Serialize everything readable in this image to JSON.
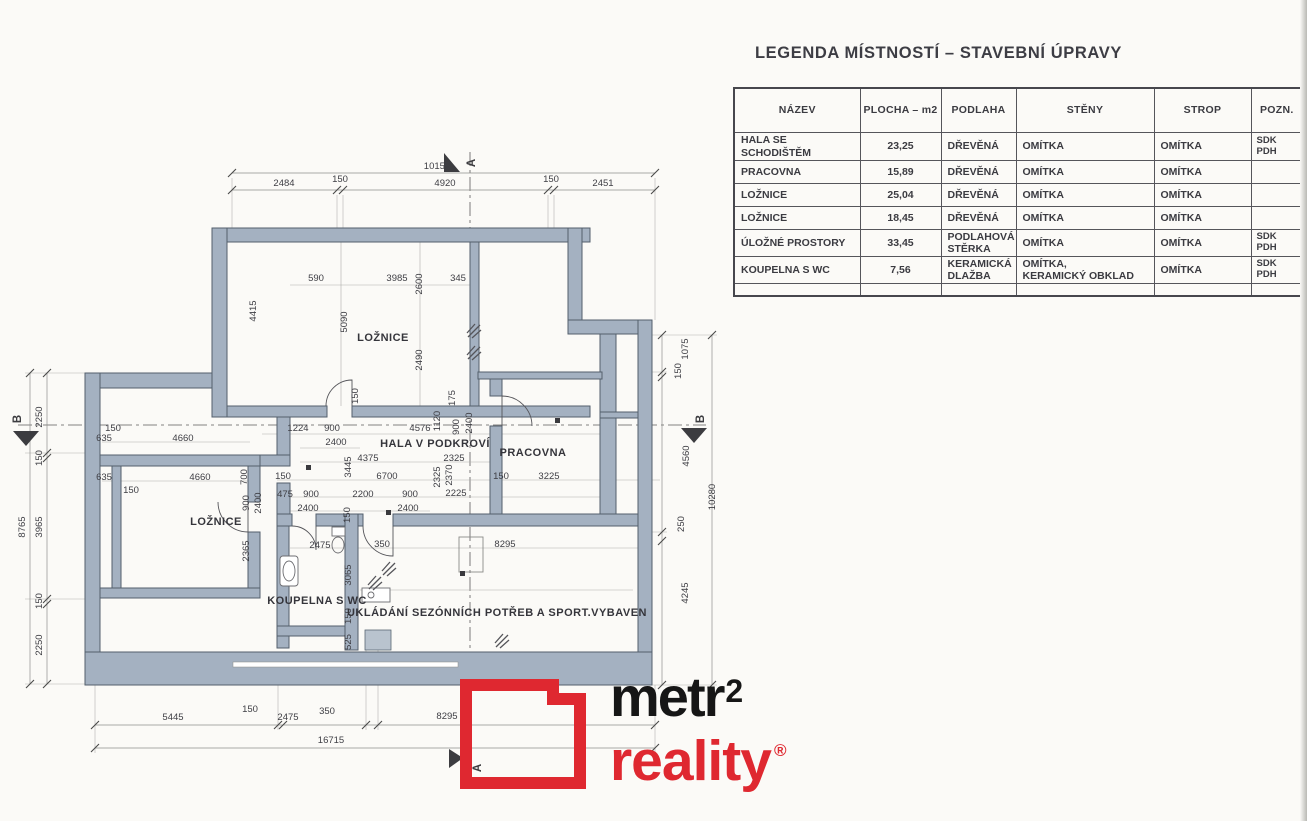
{
  "colors": {
    "wall_fill": "#a4b1c1",
    "wall_edge": "#535f6c",
    "logo_red": "#df2830",
    "logo_black": "#161616",
    "dim_text": "#3e3e44"
  },
  "legend": {
    "title": "LEGENDA MÍSTNOSTÍ – STAVEBNÍ ÚPRAVY",
    "table": {
      "headers": [
        "NÁZEV",
        "PLOCHA – m2",
        "PODLAHA",
        "STĚNY",
        "STROP",
        "POZN."
      ],
      "rows": [
        {
          "nazev": "HALA SE SCHODIŠTĚM",
          "plocha": "23,25",
          "podlaha": "DŘEVĚNÁ",
          "steny": "OMÍTKA",
          "strop": "OMÍTKA",
          "pozn": "SDK\nPDH"
        },
        {
          "nazev": "PRACOVNA",
          "plocha": "15,89",
          "podlaha": "DŘEVĚNÁ",
          "steny": "OMÍTKA",
          "strop": "OMÍTKA",
          "pozn": ""
        },
        {
          "nazev": "LOŽNICE",
          "plocha": "25,04",
          "podlaha": "DŘEVĚNÁ",
          "steny": "OMÍTKA",
          "strop": "OMÍTKA",
          "pozn": ""
        },
        {
          "nazev": "LOŽNICE",
          "plocha": "18,45",
          "podlaha": "DŘEVĚNÁ",
          "steny": "OMÍTKA",
          "strop": "OMÍTKA",
          "pozn": ""
        },
        {
          "nazev": "ÚLOŽNÉ PROSTORY",
          "plocha": "33,45",
          "podlaha": "PODLAHOVÁ\nSTĚRKA",
          "steny": "OMÍTKA",
          "strop": "OMÍTKA",
          "pozn": "SDK\nPDH"
        },
        {
          "nazev": "KOUPELNA S WC",
          "plocha": "7,56",
          "podlaha": "KERAMICKÁ\nDLAŽBA",
          "steny": "OMÍTKA,\nKERAMICKÝ OBKLAD",
          "strop": "OMÍTKA",
          "pozn": "SDK\nPDH"
        }
      ]
    }
  },
  "plan": {
    "room_labels": [
      {
        "t": "LOŽNICE",
        "x": 383,
        "y": 341
      },
      {
        "t": "HALA V PODKROVÍ",
        "x": 435,
        "y": 447
      },
      {
        "t": "PRACOVNA",
        "x": 533,
        "y": 456
      },
      {
        "t": "LOŽNICE",
        "x": 216,
        "y": 525
      },
      {
        "t": "KOUPELNA S WC",
        "x": 317,
        "y": 604
      },
      {
        "t": "UKLÁDÁNÍ SEZÓNNÍCH POTŘEB A SPORT.VYBAVEN",
        "x": 497,
        "y": 616
      }
    ],
    "section_markers": [
      {
        "t": "A",
        "x": 475,
        "y": 163,
        "r": -90
      },
      {
        "t": "A",
        "x": 481,
        "y": 768,
        "r": -90
      },
      {
        "t": "B",
        "x": 21,
        "y": 419,
        "r": -90
      },
      {
        "t": "B",
        "x": 704,
        "y": 419,
        "r": -90
      }
    ],
    "dim_texts": [
      {
        "t": "10155",
        "x": 437,
        "y": 169
      },
      {
        "t": "2484",
        "x": 284,
        "y": 186
      },
      {
        "t": "150",
        "x": 340,
        "y": 182
      },
      {
        "t": "4920",
        "x": 445,
        "y": 186
      },
      {
        "t": "150",
        "x": 551,
        "y": 182
      },
      {
        "t": "2451",
        "x": 603,
        "y": 186
      },
      {
        "t": "590",
        "x": 316,
        "y": 281
      },
      {
        "t": "3985",
        "x": 397,
        "y": 281
      },
      {
        "t": "345",
        "x": 458,
        "y": 281
      },
      {
        "t": "2600",
        "x": 422,
        "y": 284,
        "r": -90
      },
      {
        "t": "4415",
        "x": 256,
        "y": 311,
        "r": -90
      },
      {
        "t": "5090",
        "x": 347,
        "y": 322,
        "r": -90
      },
      {
        "t": "2490",
        "x": 422,
        "y": 360,
        "r": -90
      },
      {
        "t": "150",
        "x": 358,
        "y": 396,
        "r": -90
      },
      {
        "t": "175",
        "x": 455,
        "y": 398,
        "r": -90
      },
      {
        "t": "1224",
        "x": 298,
        "y": 431
      },
      {
        "t": "900",
        "x": 332,
        "y": 431
      },
      {
        "t": "2400",
        "x": 336,
        "y": 445
      },
      {
        "t": "4576",
        "x": 420,
        "y": 431
      },
      {
        "t": "1120",
        "x": 440,
        "y": 421,
        "r": -90
      },
      {
        "t": "900",
        "x": 459,
        "y": 427,
        "r": -90
      },
      {
        "t": "2400",
        "x": 472,
        "y": 423,
        "r": -90
      },
      {
        "t": "4375",
        "x": 368,
        "y": 461
      },
      {
        "t": "2325",
        "x": 454,
        "y": 461
      },
      {
        "t": "3445",
        "x": 351,
        "y": 467,
        "r": -90
      },
      {
        "t": "150",
        "x": 283,
        "y": 479
      },
      {
        "t": "6700",
        "x": 387,
        "y": 479
      },
      {
        "t": "150",
        "x": 501,
        "y": 479
      },
      {
        "t": "3225",
        "x": 549,
        "y": 479
      },
      {
        "t": "2325",
        "x": 440,
        "y": 477,
        "r": -90
      },
      {
        "t": "2370",
        "x": 452,
        "y": 475,
        "r": -90
      },
      {
        "t": "475",
        "x": 285,
        "y": 497
      },
      {
        "t": "900",
        "x": 311,
        "y": 497
      },
      {
        "t": "2400",
        "x": 308,
        "y": 511
      },
      {
        "t": "2200",
        "x": 363,
        "y": 497
      },
      {
        "t": "900",
        "x": 410,
        "y": 497
      },
      {
        "t": "2400",
        "x": 408,
        "y": 511
      },
      {
        "t": "2225",
        "x": 456,
        "y": 496
      },
      {
        "t": "150",
        "x": 350,
        "y": 515,
        "r": -90
      },
      {
        "t": "150",
        "x": 113,
        "y": 431
      },
      {
        "t": "635",
        "x": 104,
        "y": 441
      },
      {
        "t": "4660",
        "x": 183,
        "y": 441
      },
      {
        "t": "635",
        "x": 104,
        "y": 480
      },
      {
        "t": "150",
        "x": 131,
        "y": 493
      },
      {
        "t": "4660",
        "x": 200,
        "y": 480
      },
      {
        "t": "700",
        "x": 247,
        "y": 477,
        "r": -90
      },
      {
        "t": "900",
        "x": 249,
        "y": 503,
        "r": -90
      },
      {
        "t": "2400",
        "x": 261,
        "y": 503,
        "r": -90
      },
      {
        "t": "2365",
        "x": 249,
        "y": 551,
        "r": -90
      },
      {
        "t": "2475",
        "x": 320,
        "y": 548
      },
      {
        "t": "350",
        "x": 382,
        "y": 547
      },
      {
        "t": "8295",
        "x": 505,
        "y": 547
      },
      {
        "t": "3065",
        "x": 351,
        "y": 575,
        "r": -90
      },
      {
        "t": "150",
        "x": 351,
        "y": 616,
        "r": -90
      },
      {
        "t": "525",
        "x": 351,
        "y": 642,
        "r": -90
      },
      {
        "t": "5445",
        "x": 173,
        "y": 720
      },
      {
        "t": "150",
        "x": 250,
        "y": 712
      },
      {
        "t": "2475",
        "x": 288,
        "y": 720
      },
      {
        "t": "350",
        "x": 327,
        "y": 714
      },
      {
        "t": "8295",
        "x": 447,
        "y": 719
      },
      {
        "t": "16715",
        "x": 331,
        "y": 743
      },
      {
        "t": "2250",
        "x": 42,
        "y": 417,
        "r": -90
      },
      {
        "t": "150",
        "x": 42,
        "y": 458,
        "r": -90
      },
      {
        "t": "3965",
        "x": 42,
        "y": 527,
        "r": -90
      },
      {
        "t": "150",
        "x": 42,
        "y": 601,
        "r": -90
      },
      {
        "t": "2250",
        "x": 42,
        "y": 645,
        "r": -90
      },
      {
        "t": "8765",
        "x": 25,
        "y": 527,
        "r": -90
      },
      {
        "t": "1075",
        "x": 688,
        "y": 349,
        "r": -90
      },
      {
        "t": "150",
        "x": 681,
        "y": 371,
        "r": -90
      },
      {
        "t": "4560",
        "x": 689,
        "y": 456,
        "r": -90
      },
      {
        "t": "250",
        "x": 684,
        "y": 524,
        "r": -90
      },
      {
        "t": "4245",
        "x": 688,
        "y": 593,
        "r": -90
      },
      {
        "t": "10280",
        "x": 715,
        "y": 497,
        "r": -90
      }
    ]
  },
  "logo": {
    "word1": "metr",
    "sup": "2",
    "word2": "reality",
    "reg": "®"
  }
}
